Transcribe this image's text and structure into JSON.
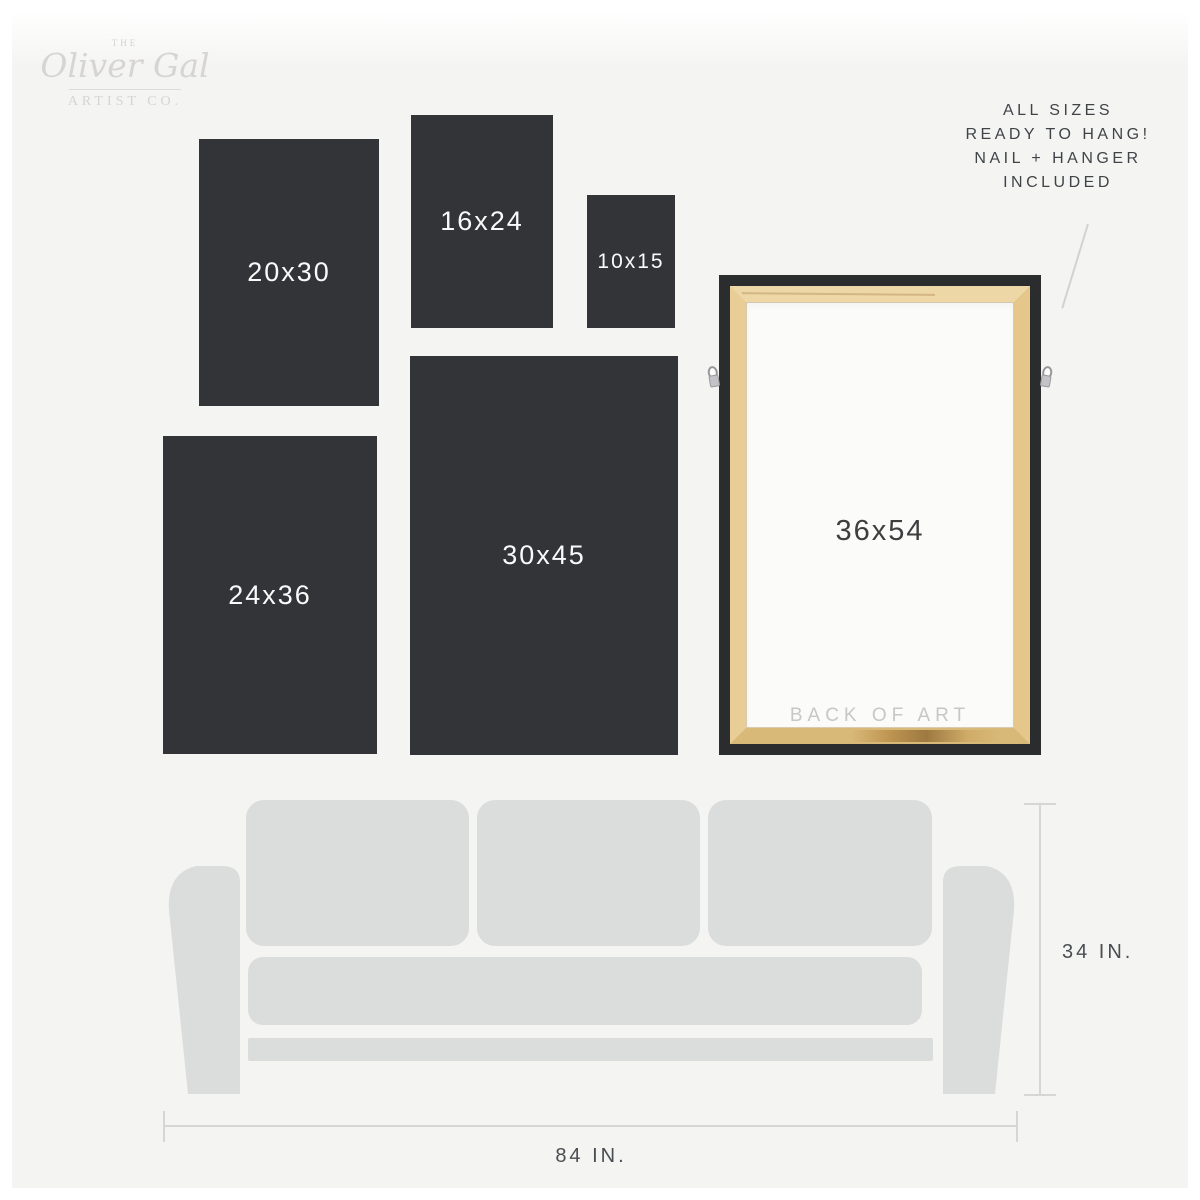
{
  "brand": {
    "the": "THE",
    "name": "Oliver Gal",
    "subtitle": "ARTIST CO."
  },
  "note": {
    "lines": [
      "ALL SIZES",
      "READY TO HANG!",
      "NAIL + HANGER",
      "INCLUDED"
    ]
  },
  "size_boxes": {
    "s2030": {
      "label": "20x30"
    },
    "s1624": {
      "label": "16x24"
    },
    "s1015": {
      "label": "10x15"
    },
    "s2436": {
      "label": "24x36"
    },
    "s3045": {
      "label": "30x45"
    }
  },
  "frame": {
    "label": "36x54",
    "back_label": "BACK OF ART"
  },
  "couch_dimensions": {
    "height_label": "34 IN.",
    "width_label": "84 IN."
  },
  "colors": {
    "background": "#f4f4f2",
    "mat_white": "#ffffff",
    "box_dark": "#333438",
    "box_text": "#fafafa",
    "frame_black": "#2b2c2e",
    "wood": "#e5c78c",
    "canvas_white": "#fbfbf9",
    "couch_gray": "#dbdcdc",
    "dim_line_gray": "#d6d6d4",
    "note_text": "#404448",
    "logo_gray": "#d7d5d3"
  }
}
